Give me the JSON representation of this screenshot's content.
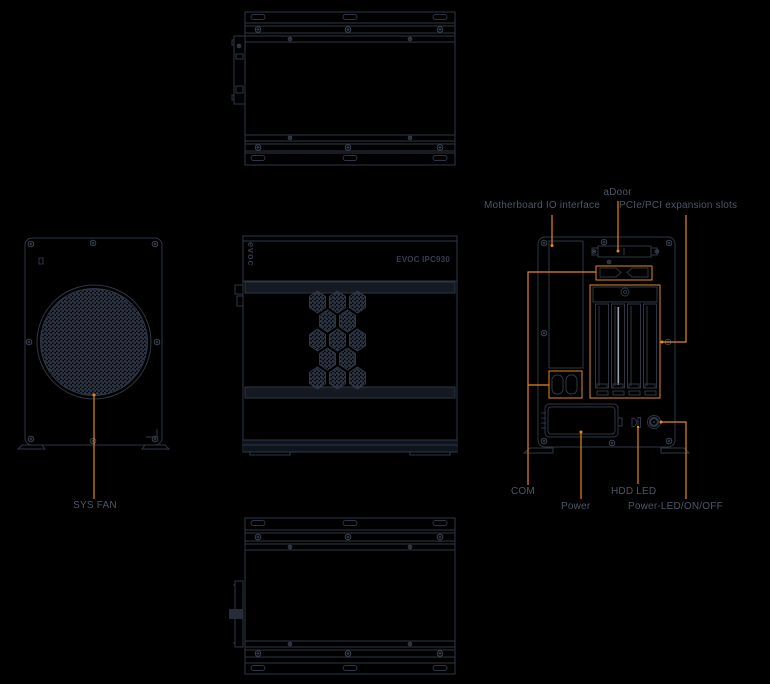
{
  "colors": {
    "background": "#000000",
    "line": "#2e3645",
    "screw_line": "#39424f",
    "accent_orange": "#e8871c",
    "label_text": "#4d5565",
    "panel_fill": "#141922",
    "mesh_fill": "#232b38",
    "slot_cover_highlight": "#9aa0a8"
  },
  "front_view": {
    "logo_text": "evoc",
    "model_label": "EVOC IPC930"
  },
  "annotations": {
    "sys_fan": {
      "label": "SYS FAN"
    },
    "adoor": {
      "label": "aDoor"
    },
    "motherboard_io": {
      "label": "Motherboard IO interface"
    },
    "pcie_slots": {
      "label": "PCIe/PCI expansion slots"
    },
    "com": {
      "label": "COM"
    },
    "power": {
      "label": "Power"
    },
    "hdd_led": {
      "label": "HDD LED"
    },
    "power_led": {
      "label": "Power-LED/ON/OFF"
    }
  }
}
